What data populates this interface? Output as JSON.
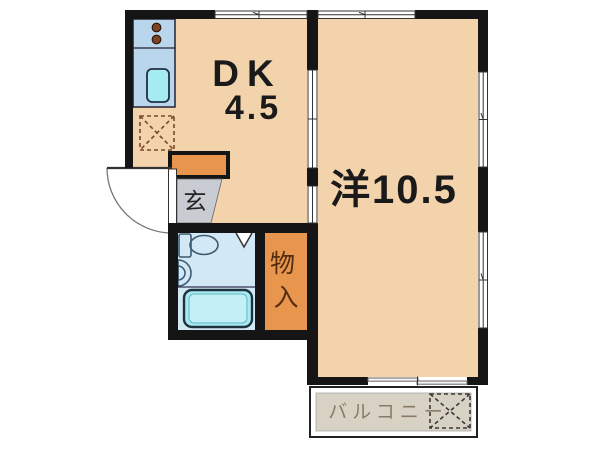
{
  "floorplan": {
    "rooms": {
      "dk": {
        "label": "DK",
        "size": "4.5"
      },
      "western": {
        "label": "洋10.5"
      },
      "entrance": {
        "label": "玄"
      },
      "storage": {
        "label": "物入",
        "chars": [
          "物",
          "入"
        ]
      },
      "balcony": {
        "label": "バルコニー"
      }
    },
    "fixtures": {
      "stove": "two-burner-stove",
      "kitchen_sink": "kitchen-sink",
      "refrigerator_space": "dashed-box-x",
      "toilet": "toilet",
      "washbasin": "washbasin",
      "bathtub": "bathtub",
      "washing_machine_space": "dashed-box-x",
      "entrance_door": "swing-door-arc",
      "windows": "sliding-window",
      "partition": "sliding-door"
    },
    "palette": {
      "wall": "#151515",
      "room_floor": "#f2d3ac",
      "bathroom_floor": "#d3e8f5",
      "storage_fill": "#e8954e",
      "cabinet_fill": "#e8954e",
      "entrance_floor": "#c8ccd2",
      "balcony_fill": "#d8d2c5",
      "counter_fill": "#b9d6ec",
      "sink_fill": "#a5ebf2",
      "tub_fill": "#abe9f1",
      "burner_fill": "#7c4422",
      "dash_brown": "#7a4a28",
      "dash_dark": "#3a3a3a",
      "balcony_text": "#8a7b67",
      "storage_text": "#532d12",
      "label_text": "#1a1a1a"
    }
  }
}
